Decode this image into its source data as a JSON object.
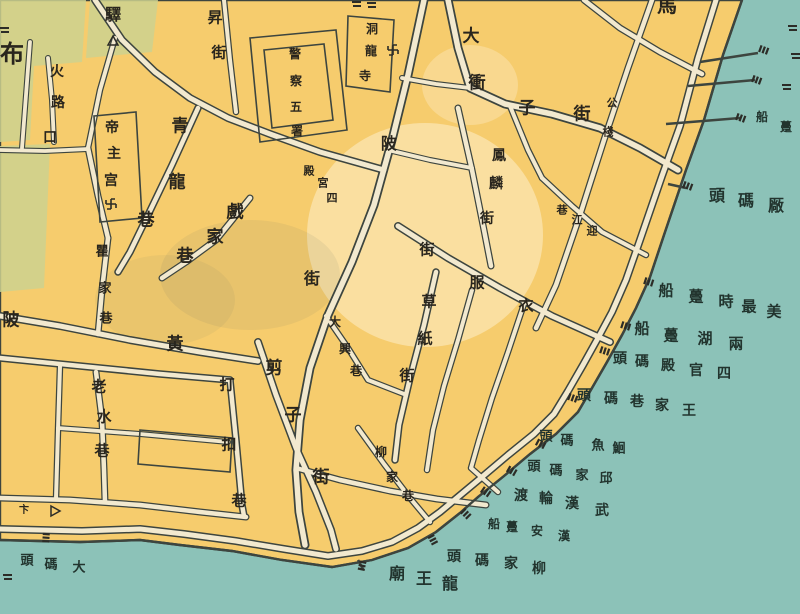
{
  "map": {
    "type": "historical-city-map",
    "colors": {
      "water": "#8cc2b8",
      "land": "#f6cc6d",
      "road": "#f2e9cf",
      "line": "#3d453f",
      "green_block": "#cdd18f",
      "land_text": "#29251d",
      "water_text": "#22342e"
    },
    "street_labels": [
      {
        "id": "bu-char",
        "value": "布",
        "zone": "land",
        "size": 24,
        "chars": [
          [
            "布",
            12,
            54
          ]
        ]
      },
      {
        "id": "huolukou",
        "value": "火路口",
        "zone": "land",
        "size": 14,
        "chars": [
          [
            "火",
            57,
            72
          ],
          [
            "路",
            58,
            103
          ],
          [
            "口",
            50,
            138
          ]
        ]
      },
      {
        "id": "yi-post",
        "value": "驛",
        "zone": "land",
        "size": 16,
        "chars": [
          [
            "驛",
            113,
            15
          ]
        ]
      },
      {
        "id": "dizhugong",
        "value": "帝主宫",
        "zone": "land",
        "size": 14,
        "chars": [
          [
            "帝",
            112,
            128
          ],
          [
            "主",
            114,
            154
          ],
          [
            "宫",
            111,
            181
          ]
        ]
      },
      {
        "id": "qinglongxiang",
        "value": "青龍巷",
        "zone": "land",
        "size": 17,
        "chars": [
          [
            "青",
            180,
            127
          ],
          [
            "龍",
            177,
            183
          ],
          [
            "巷",
            146,
            221
          ]
        ]
      },
      {
        "id": "xijiaxiang",
        "value": "戲家巷",
        "zone": "land",
        "size": 17,
        "chars": [
          [
            "戲",
            235,
            213
          ],
          [
            "家",
            215,
            238
          ],
          [
            "巷",
            185,
            257
          ]
        ]
      },
      {
        "id": "qujiaxiang",
        "value": "瞿家巷",
        "zone": "land",
        "size": 13,
        "chars": [
          [
            "瞿",
            102,
            252
          ],
          [
            "家",
            105,
            289
          ],
          [
            "巷",
            106,
            319
          ]
        ]
      },
      {
        "id": "huangpijie",
        "value": "黃陂",
        "zone": "land",
        "size": 17,
        "chars": [
          [
            "陂",
            11,
            321
          ],
          [
            "黃",
            175,
            345
          ]
        ]
      },
      {
        "id": "laoshuixiang",
        "value": "老水巷",
        "zone": "land",
        "size": 15,
        "chars": [
          [
            "老",
            99,
            387
          ],
          [
            "水",
            104,
            417
          ],
          [
            "巷",
            102,
            451
          ]
        ]
      },
      {
        "id": "dakouxiang",
        "value": "打扣巷",
        "zone": "land",
        "size": 15,
        "chars": [
          [
            "打",
            227,
            385
          ],
          [
            "扣",
            229,
            445
          ],
          [
            "巷",
            239,
            501
          ]
        ]
      },
      {
        "id": "jianzijie",
        "value": "剪子街",
        "zone": "land",
        "size": 17,
        "chars": [
          [
            "剪",
            274,
            369
          ],
          [
            "子",
            293,
            416
          ],
          [
            "街",
            321,
            478
          ]
        ]
      },
      {
        "id": "daxingxiang",
        "value": "大興巷",
        "zone": "land",
        "size": 12,
        "chars": [
          [
            "大",
            335,
            322
          ],
          [
            "興",
            345,
            349
          ],
          [
            "巷",
            356,
            371
          ]
        ]
      },
      {
        "id": "liujiaxiang",
        "value": "柳家巷",
        "zone": "land",
        "size": 12,
        "chars": [
          [
            "柳",
            381,
            452
          ],
          [
            "家",
            392,
            477
          ],
          [
            "巷",
            408,
            496
          ]
        ]
      },
      {
        "id": "caozhijie",
        "value": "草紙街",
        "zone": "land",
        "size": 15,
        "chars": [
          [
            "草",
            429,
            302
          ],
          [
            "紙",
            425,
            339
          ],
          [
            "街",
            407,
            376
          ]
        ]
      },
      {
        "id": "yifujie",
        "value": "衣服街",
        "zone": "land",
        "size": 15,
        "chars": [
          [
            "街",
            427,
            250
          ],
          [
            "服",
            477,
            283
          ],
          [
            "衣",
            526,
            306
          ]
        ]
      },
      {
        "id": "fenglinjie",
        "value": "鳳麟街",
        "zone": "land",
        "size": 14,
        "chars": [
          [
            "鳳",
            499,
            156
          ],
          [
            "麟",
            496,
            184
          ],
          [
            "街",
            487,
            219
          ]
        ]
      },
      {
        "id": "yingjiangxiang",
        "value": "迎江巷",
        "zone": "land",
        "size": 11,
        "chars": [
          [
            "巷",
            562,
            210
          ],
          [
            "江",
            577,
            220
          ],
          [
            "迎",
            592,
            231
          ]
        ]
      },
      {
        "id": "donglongsi",
        "value": "洞龍寺",
        "zone": "land",
        "size": 12,
        "chars": [
          [
            "洞",
            372,
            29
          ],
          [
            "龍",
            371,
            51
          ],
          [
            "寺",
            365,
            76
          ]
        ]
      },
      {
        "id": "jingchawushu",
        "value": "警察五署",
        "zone": "land",
        "size": 12,
        "chars": [
          [
            "警",
            295,
            54
          ],
          [
            "察",
            296,
            81
          ],
          [
            "五",
            296,
            107
          ],
          [
            "署",
            297,
            131
          ]
        ]
      },
      {
        "id": "siguandian",
        "value": "四官殿",
        "zone": "land",
        "size": 11,
        "chars": [
          [
            "殿",
            309,
            171
          ],
          [
            "宮",
            323,
            183
          ],
          [
            "四",
            332,
            198
          ]
        ]
      },
      {
        "id": "dachongzijie",
        "value": "大衝子街",
        "zone": "land",
        "size": 17,
        "chars": [
          [
            "大",
            471,
            37
          ],
          [
            "衝",
            477,
            84
          ],
          [
            "子",
            527,
            109
          ],
          [
            "街",
            582,
            115
          ]
        ]
      },
      {
        "id": "gongzhan",
        "value": "公棧",
        "zone": "land",
        "size": 11,
        "chars": [
          [
            "公",
            612,
            103
          ],
          [
            "棧",
            608,
            132
          ]
        ]
      },
      {
        "id": "shengjie",
        "value": "昇街",
        "zone": "land",
        "size": 15,
        "chars": [
          [
            "昇",
            215,
            18
          ],
          [
            "街",
            219,
            53
          ]
        ]
      },
      {
        "id": "ma-partial",
        "value": "馬",
        "zone": "land",
        "size": 20,
        "chars": [
          [
            "馬",
            667,
            5
          ]
        ]
      },
      {
        "id": "pi-char",
        "value": "陂",
        "zone": "land",
        "size": 16,
        "chars": [
          [
            "陂",
            389,
            144
          ]
        ]
      },
      {
        "id": "jie-char",
        "value": "街",
        "zone": "land",
        "size": 16,
        "chars": [
          [
            "街",
            312,
            279
          ]
        ]
      },
      {
        "id": "bian-char",
        "value": "卞",
        "zone": "land",
        "size": 10,
        "chars": [
          [
            "卞",
            24,
            511
          ]
        ]
      }
    ],
    "pier_labels": [
      {
        "id": "changmatou",
        "value": "厰碼頭",
        "zone": "water",
        "size": 16,
        "chars": [
          [
            "頭",
            717,
            196
          ],
          [
            "碼",
            746,
            201
          ],
          [
            "厰",
            776,
            206
          ]
        ]
      },
      {
        "id": "meizuishi-dunchuan",
        "value": "美最時躉船",
        "zone": "water",
        "size": 15,
        "chars": [
          [
            "船",
            666,
            291
          ],
          [
            "躉",
            696,
            297
          ],
          [
            "時",
            726,
            302
          ],
          [
            "最",
            749,
            307
          ],
          [
            "美",
            774,
            312
          ]
        ]
      },
      {
        "id": "lianghu-dunchuan",
        "value": "兩湖躉船",
        "zone": "water",
        "size": 15,
        "chars": [
          [
            "船",
            642,
            329
          ],
          [
            "躉",
            671,
            336
          ],
          [
            "湖",
            705,
            339
          ],
          [
            "兩",
            736,
            344
          ]
        ]
      },
      {
        "id": "siguandian-matou",
        "value": "四官殿碼頭",
        "zone": "water",
        "size": 14,
        "chars": [
          [
            "頭",
            620,
            359
          ],
          [
            "碼",
            642,
            362
          ],
          [
            "殿",
            668,
            366
          ],
          [
            "官",
            696,
            371
          ],
          [
            "四",
            724,
            374
          ]
        ]
      },
      {
        "id": "wangjiaxiang-matou",
        "value": "王家巷碼頭",
        "zone": "water",
        "size": 14,
        "chars": [
          [
            "頭",
            584,
            396
          ],
          [
            "碼",
            611,
            399
          ],
          [
            "巷",
            637,
            402
          ],
          [
            "家",
            662,
            406
          ],
          [
            "王",
            689,
            411
          ]
        ]
      },
      {
        "id": "huiyu-matou",
        "value": "鮰魚碼頭",
        "zone": "water",
        "size": 13,
        "chars": [
          [
            "頭",
            546,
            437
          ],
          [
            "碼",
            567,
            441
          ],
          [
            "魚",
            598,
            446
          ],
          [
            "鮰",
            619,
            449
          ]
        ]
      },
      {
        "id": "qiujia-matou",
        "value": "邱家碼頭",
        "zone": "water",
        "size": 13,
        "chars": [
          [
            "頭",
            534,
            467
          ],
          [
            "碼",
            556,
            471
          ],
          [
            "家",
            582,
            476
          ],
          [
            "邱",
            606,
            479
          ]
        ]
      },
      {
        "id": "wuhan-lundu",
        "value": "武漢輪渡",
        "zone": "water",
        "size": 14,
        "chars": [
          [
            "渡",
            521,
            496
          ],
          [
            "輪",
            546,
            499
          ],
          [
            "漢",
            572,
            504
          ],
          [
            "武",
            602,
            511
          ]
        ]
      },
      {
        "id": "hanan-dunchuan",
        "value": "漢安躉船",
        "zone": "water",
        "size": 12,
        "chars": [
          [
            "船",
            494,
            524
          ],
          [
            "躉",
            512,
            527
          ],
          [
            "安",
            537,
            531
          ],
          [
            "漢",
            564,
            536
          ]
        ]
      },
      {
        "id": "liujia-matou",
        "value": "柳家碼頭",
        "zone": "water",
        "size": 14,
        "chars": [
          [
            "頭",
            454,
            557
          ],
          [
            "碼",
            482,
            561
          ],
          [
            "家",
            511,
            564
          ],
          [
            "柳",
            539,
            569
          ]
        ]
      },
      {
        "id": "longwangmiao",
        "value": "龍王廟",
        "zone": "water",
        "size": 16,
        "chars": [
          [
            "廟",
            397,
            574
          ],
          [
            "王",
            424,
            579
          ],
          [
            "龍",
            450,
            584
          ]
        ]
      },
      {
        "id": "damatou",
        "value": "大碼頭",
        "zone": "water",
        "size": 13,
        "chars": [
          [
            "頭",
            27,
            561
          ],
          [
            "碼",
            51,
            565
          ],
          [
            "大",
            79,
            568
          ]
        ]
      },
      {
        "id": "dunchuan-partial",
        "value": "躉船",
        "zone": "water",
        "size": 12,
        "chars": [
          [
            "船",
            762,
            117
          ],
          [
            "躉",
            786,
            127
          ]
        ]
      }
    ],
    "symbols": [
      {
        "type": "swastika",
        "x": 393,
        "y": 50
      },
      {
        "type": "swastika",
        "x": 111,
        "y": 204
      },
      {
        "type": "triangle",
        "x": 113,
        "y": 41
      },
      {
        "type": "flag",
        "x": 55,
        "y": 511
      }
    ],
    "piers": [
      [
        764,
        50,
        -70
      ],
      [
        757,
        80,
        -70
      ],
      [
        741,
        118,
        -70
      ],
      [
        688,
        186,
        -70
      ],
      [
        649,
        282,
        -72
      ],
      [
        626,
        326,
        -72
      ],
      [
        605,
        351,
        -72
      ],
      [
        573,
        398,
        -70
      ],
      [
        541,
        444,
        -62
      ],
      [
        512,
        471,
        -60
      ],
      [
        486,
        492,
        -55
      ],
      [
        466,
        514,
        -45
      ],
      [
        433,
        540,
        -28
      ],
      [
        362,
        566,
        12
      ],
      [
        46,
        538,
        4
      ]
    ],
    "fragments": [
      [
        792,
        28
      ],
      [
        795,
        56
      ],
      [
        786,
        87
      ],
      [
        7,
        577
      ],
      [
        4,
        30
      ],
      [
        356,
        4
      ],
      [
        371,
        5
      ]
    ]
  }
}
